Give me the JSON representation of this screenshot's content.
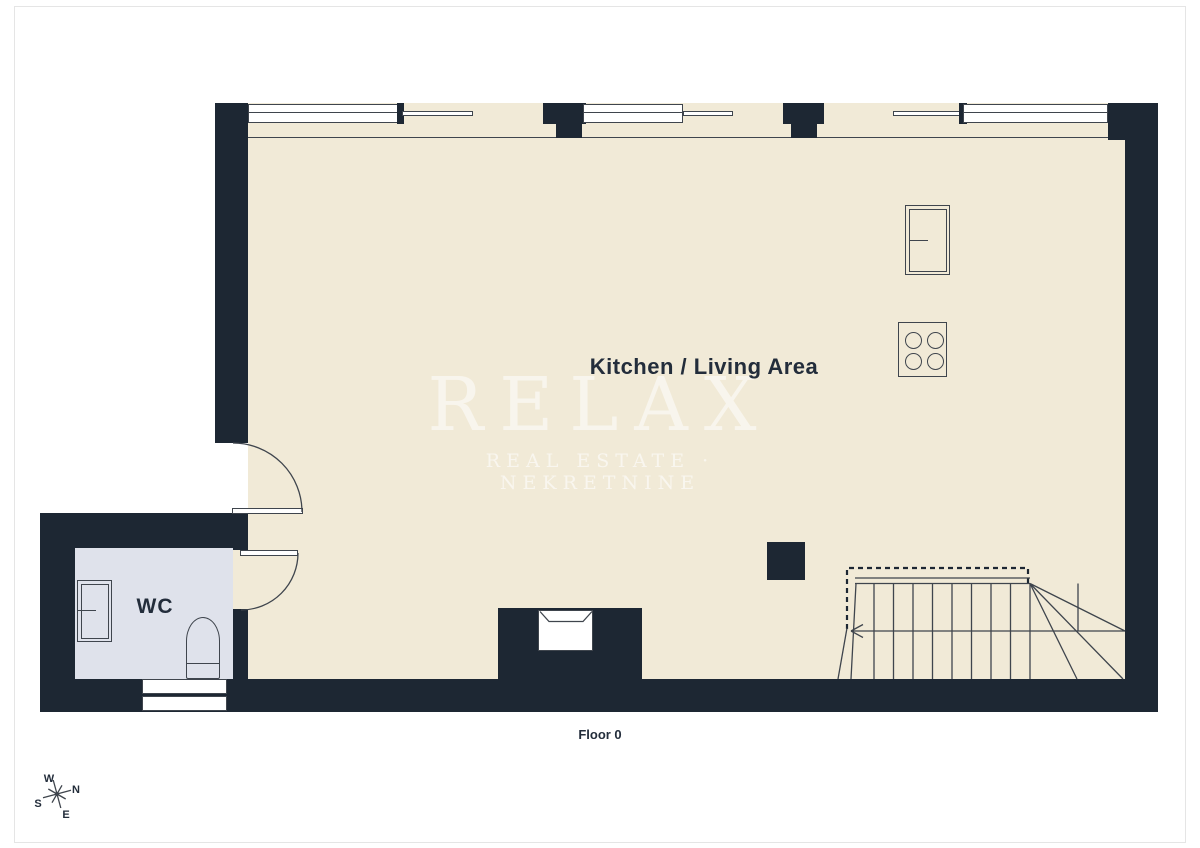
{
  "plan": {
    "room_label": "Kitchen / Living Area",
    "wc_label": "WC",
    "floor_label": "Floor 0"
  },
  "watermark": {
    "title": "RELAX",
    "subtitle": "REAL ESTATE · NEKRETNINE"
  },
  "compass": {
    "north": "N",
    "south": "S",
    "east": "E",
    "west": "W"
  },
  "colors": {
    "wall": "#1d2733",
    "floor": "#f1ead7",
    "wc_floor": "#dfe2eb",
    "ink": "#232d3b",
    "symbol_line": "#3f454d",
    "page_border": "#e5e5e5",
    "watermark_text": "#ffffff"
  }
}
